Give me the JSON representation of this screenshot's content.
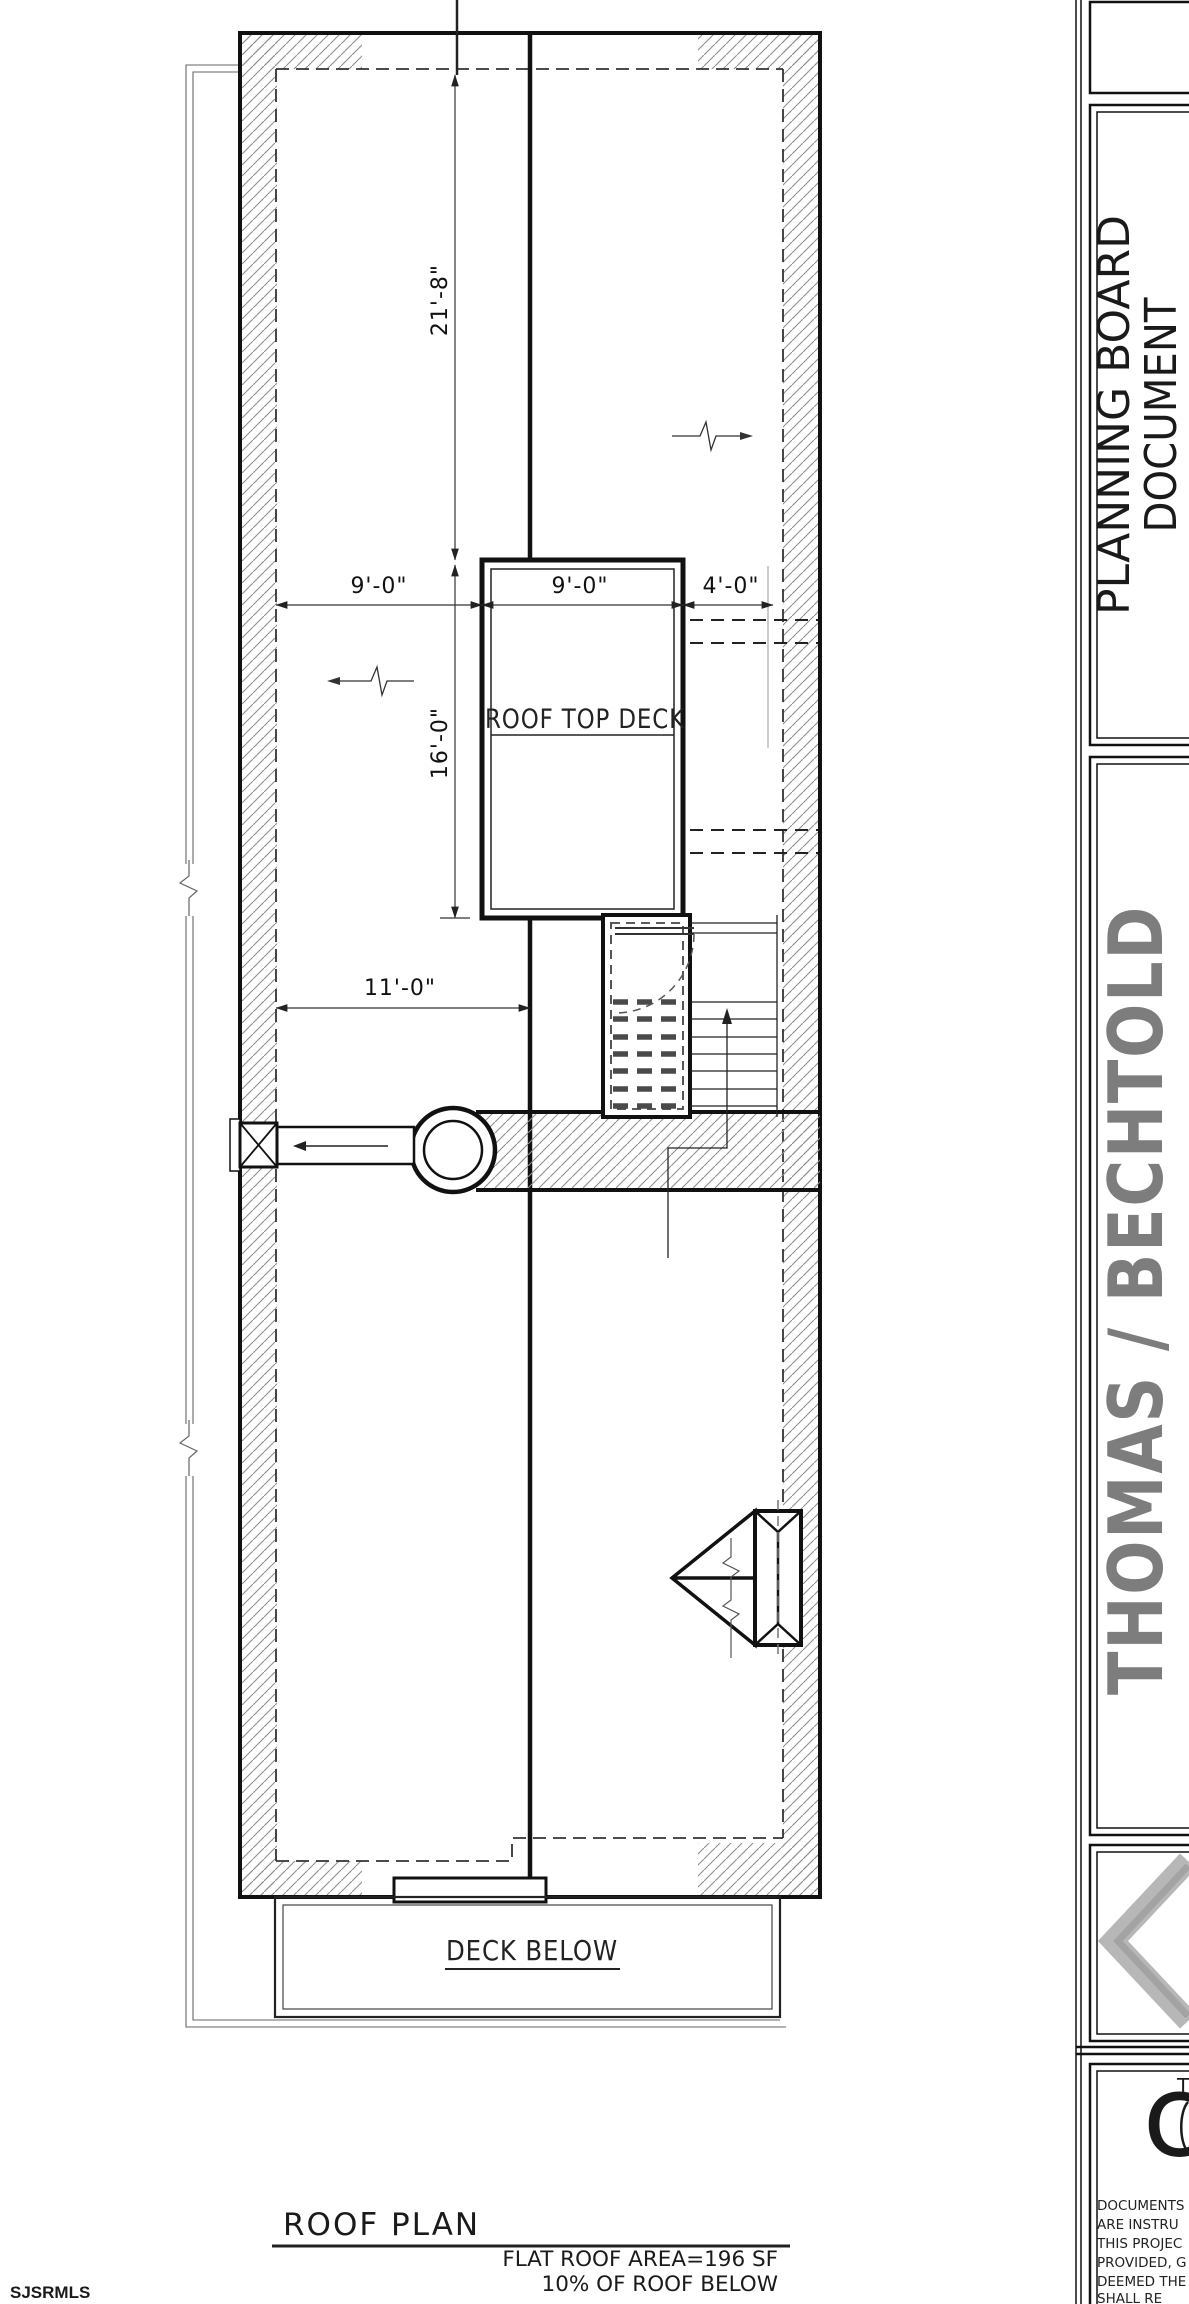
{
  "watermark": "SJSRMLS",
  "plan": {
    "title": "ROOF PLAN",
    "notes": [
      "FLAT ROOF AREA=196 SF",
      "10% OF ROOF BELOW"
    ],
    "labels": {
      "roof_top_deck": "ROOF TOP DECK",
      "deck_below": "DECK BELOW"
    },
    "dims": {
      "v_upper": "21'-8\"",
      "v_lower": "16'-0\"",
      "h_left": "9'-0\"",
      "h_mid": "9'-0\"",
      "h_right": "4'-0\"",
      "h_bottom": "11'-0\""
    }
  },
  "titleblock": {
    "stamp_line1": "PLANNING BOARD",
    "stamp_line2": "DOCUMENT",
    "project_name": "THOMAS / BECHTOLD",
    "logo_letter": "C",
    "logo_small": "T",
    "disclaimer": [
      "DOCUMENTS",
      "ARE INSTRU",
      "THIS PROJEC",
      "PROVIDED, G",
      "DEEMED THE",
      "SHALL RE"
    ]
  },
  "colors": {
    "ink": "#1a1a1a",
    "gray_text": "#7d7d7d",
    "chevron": "#b4b4b4",
    "hatch": "#8f8f8f"
  }
}
